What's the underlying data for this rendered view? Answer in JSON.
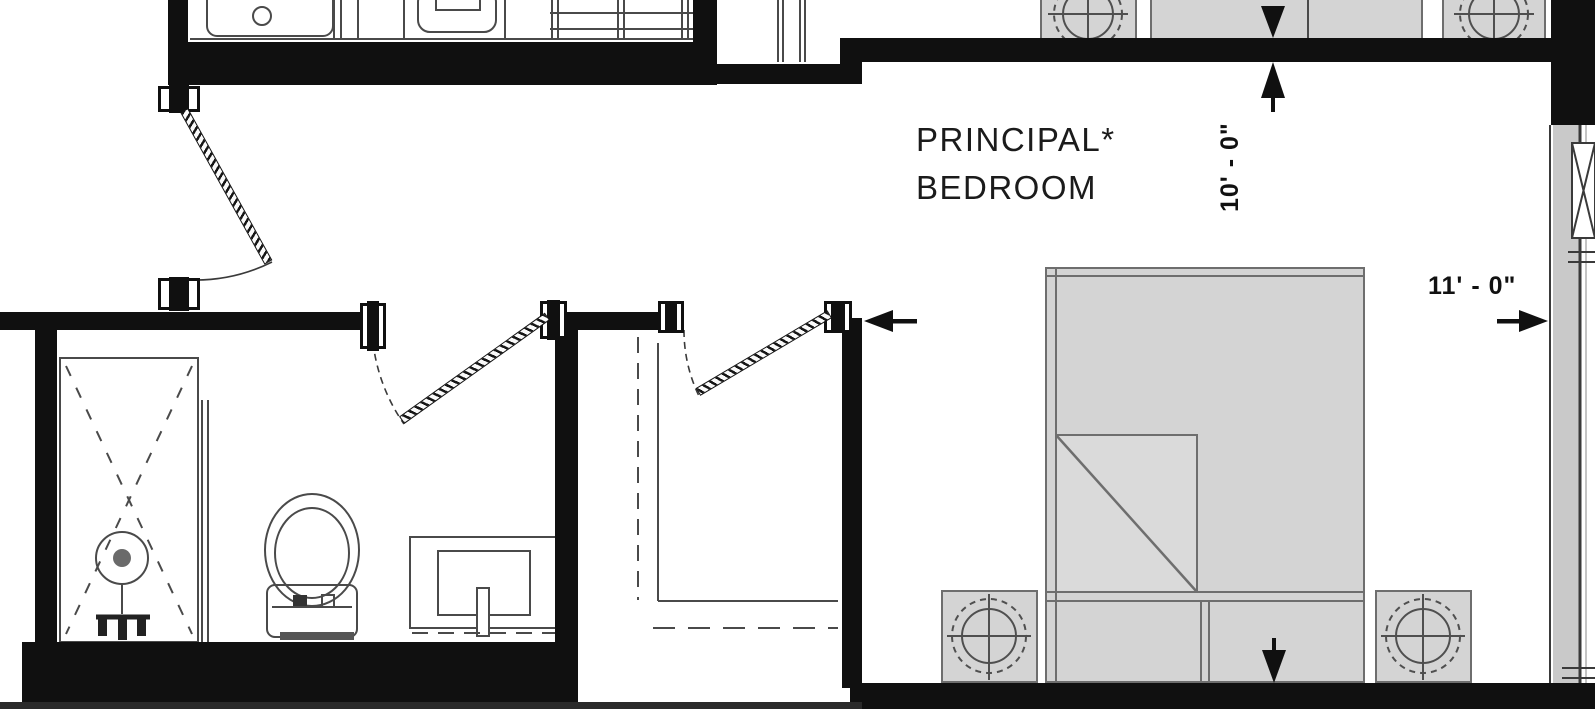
{
  "plan": {
    "room": {
      "label_line1": "PRINCIPAL*",
      "label_line2": "BEDROOM"
    },
    "dimensions": {
      "vertical": "10' - 0\"",
      "horizontal": "11' - 0\""
    },
    "colors": {
      "wall": "#101010",
      "furniture_fill": "#d4d4d4",
      "furniture_stroke": "#6e6e6e",
      "fixture_line": "#4a4a4a",
      "window_glass": "#c9c9c9",
      "background": "#ffffff",
      "text": "#1b1b1b"
    },
    "fixtures": [
      "shower-stall",
      "shower-drain",
      "toilet",
      "vanity-sink",
      "closet-rod",
      "closet-shelf",
      "bed",
      "folded-sheet",
      "pillows",
      "nightstand-lamp-left",
      "nightstand-lamp-right",
      "window-wall",
      "counter-sink",
      "cooktop",
      "shelving-unit",
      "swing-door-upper",
      "swing-door-bathroom",
      "swing-door-closet"
    ]
  }
}
